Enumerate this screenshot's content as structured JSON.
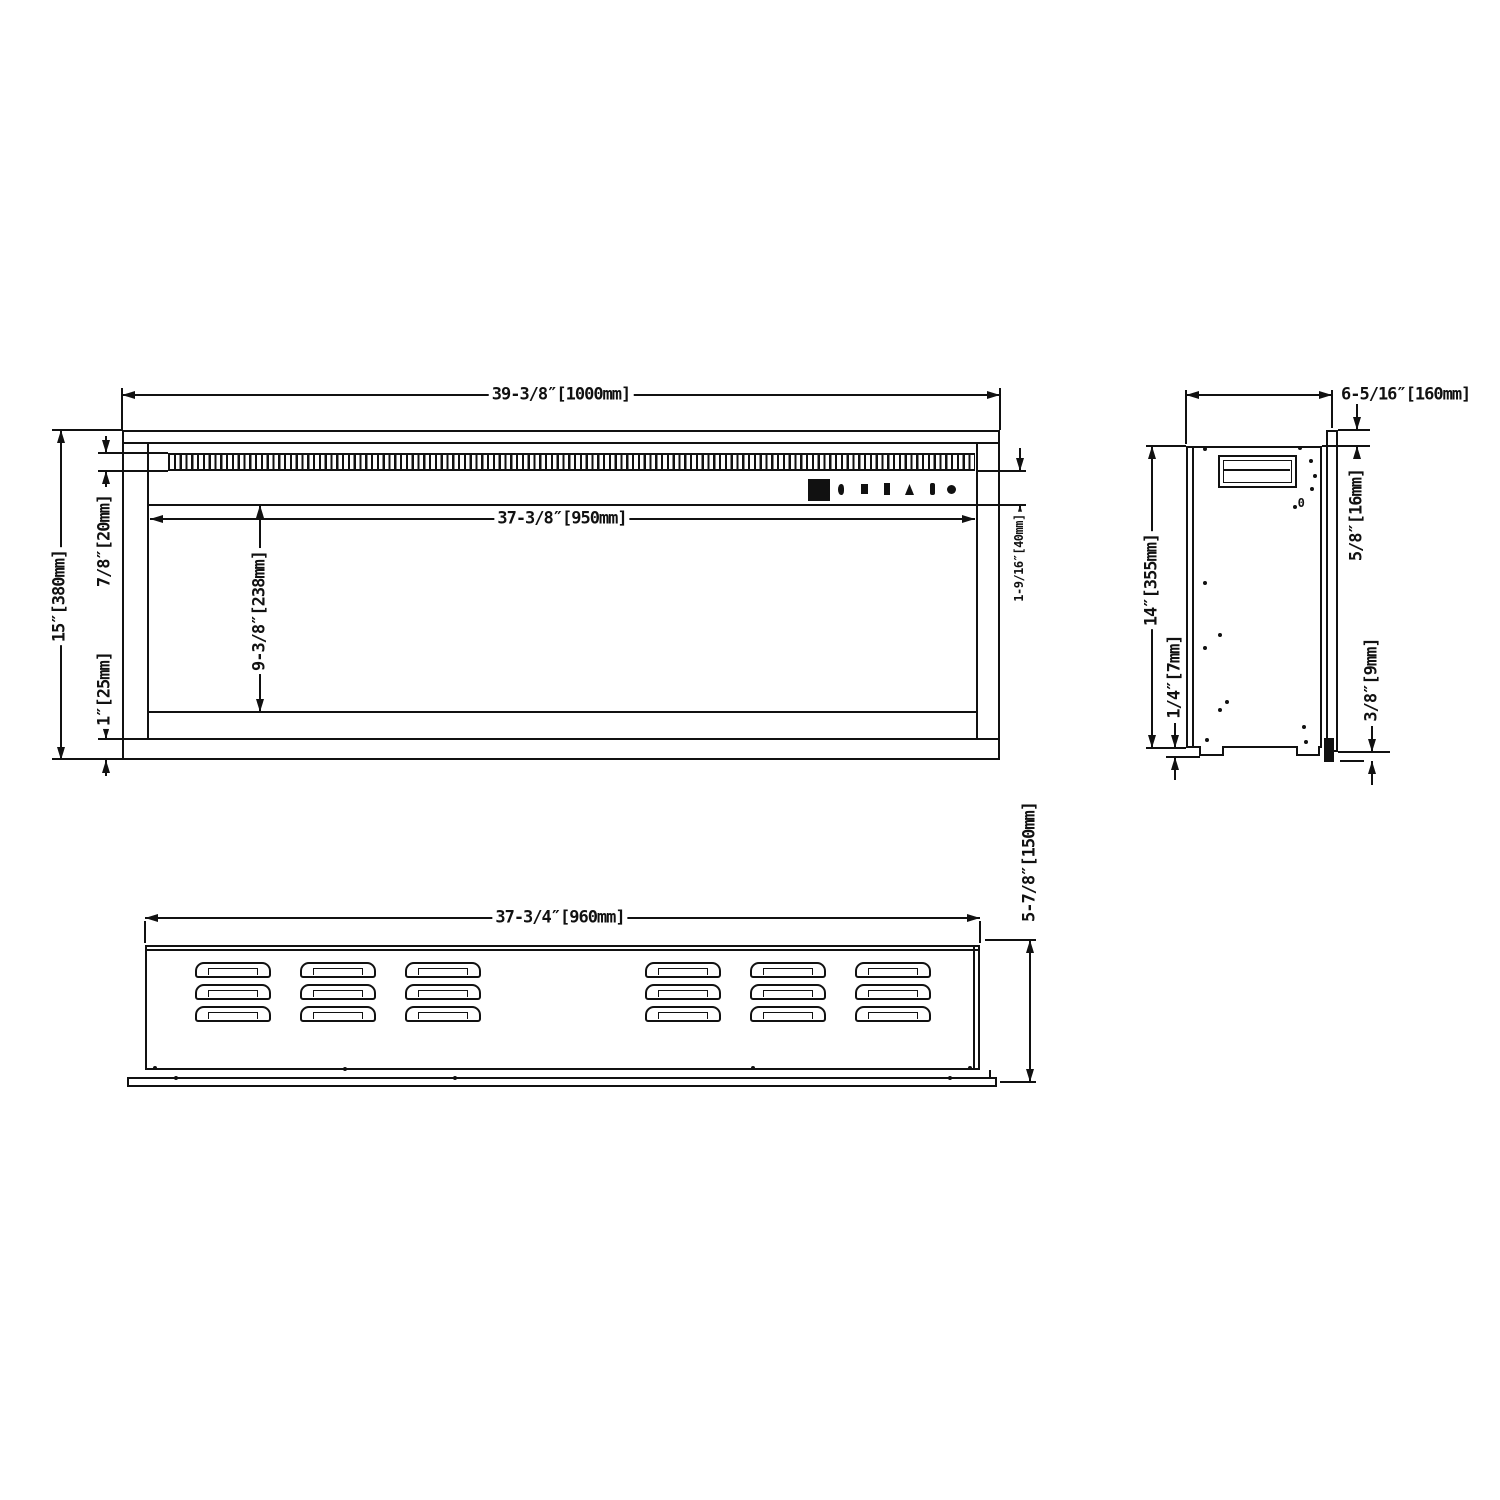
{
  "sheet": {
    "background_color": "#ffffff",
    "line_color": "#111111"
  },
  "front_view": {
    "dim_width": "39-3/8″[1000mm]",
    "dim_inner_width": "37-3/8″[950mm]",
    "dim_height": "15″[380mm]",
    "dim_grille_height": "7/8″[20mm]",
    "dim_bottom_band": "1″[25mm]",
    "dim_opening_height": "9-3/8″[238mm]",
    "dim_control_band": "1-9/16″[40mm]",
    "control_panel_icons": [
      "display-screen",
      "control-button-1",
      "control-button-2",
      "control-button-3",
      "control-button-4",
      "control-button-5",
      "control-button-6"
    ]
  },
  "side_view": {
    "dim_depth": "6-5/16″[160mm]",
    "dim_height": "14″[355mm]",
    "dim_foot_offset": "1/4″[7mm]",
    "dim_flange_top_offset": "5/8″[16mm]",
    "dim_flange_bottom_offset": "3/8″[9mm]",
    "marking_zero": "0"
  },
  "bottom_view": {
    "dim_width": "37-3/4″[960mm]",
    "dim_depth": "5-7/8″[150mm]"
  }
}
